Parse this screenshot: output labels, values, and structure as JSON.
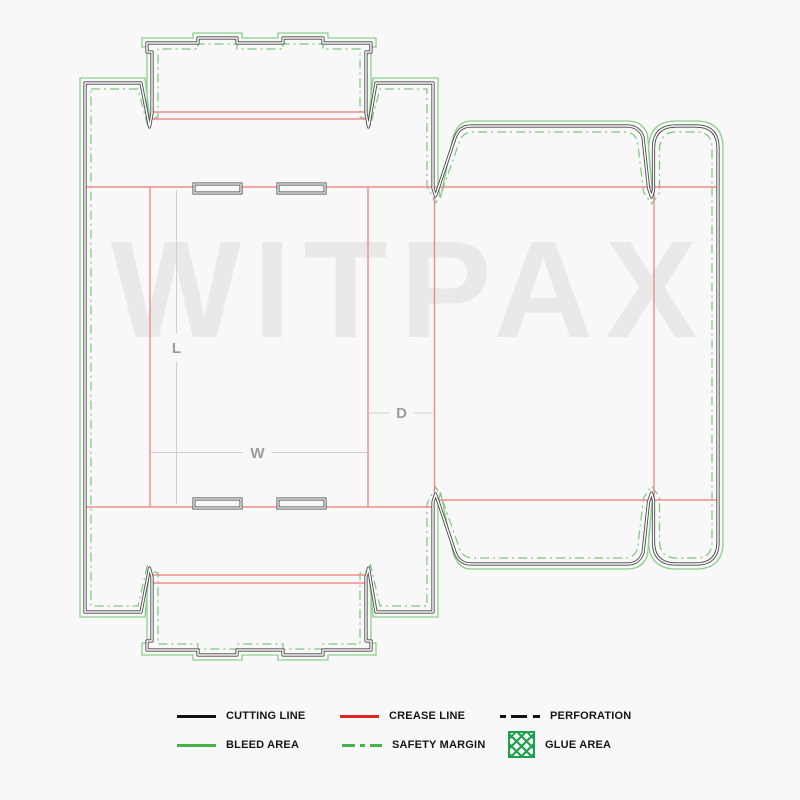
{
  "watermark": {
    "text": "WITPAX"
  },
  "dimensions": {
    "length_label": "L",
    "width_label": "W",
    "depth_label": "D"
  },
  "legend": {
    "items": [
      {
        "id": "cutting-line",
        "label": "CUTTING LINE",
        "swatch": "solid-black"
      },
      {
        "id": "crease-line",
        "label": "CREASE LINE",
        "swatch": "solid-red"
      },
      {
        "id": "perforation",
        "label": "PERFORATION",
        "swatch": "dashed-black"
      },
      {
        "id": "bleed-area",
        "label": "BLEED AREA",
        "swatch": "solid-green"
      },
      {
        "id": "safety-margin",
        "label": "SAFETY MARGIN",
        "swatch": "dashdot-green"
      },
      {
        "id": "glue-area",
        "label": "GLUE AREA",
        "swatch": "hatch-green"
      }
    ]
  },
  "colors": {
    "background": "#f8f8f8",
    "cutting": "#454545",
    "crease": "#ef8a8a",
    "bleed": "#8ccf8c",
    "safety": "#7cc77c",
    "legend-black": "#111111",
    "legend-red": "#e02424",
    "legend-green": "#46b348",
    "glue": "#1ca24c",
    "dimension": "#9c9c9c",
    "dim-line": "#cfcfcf",
    "watermark": "#e9e9e9",
    "legend-text": "#151515"
  }
}
